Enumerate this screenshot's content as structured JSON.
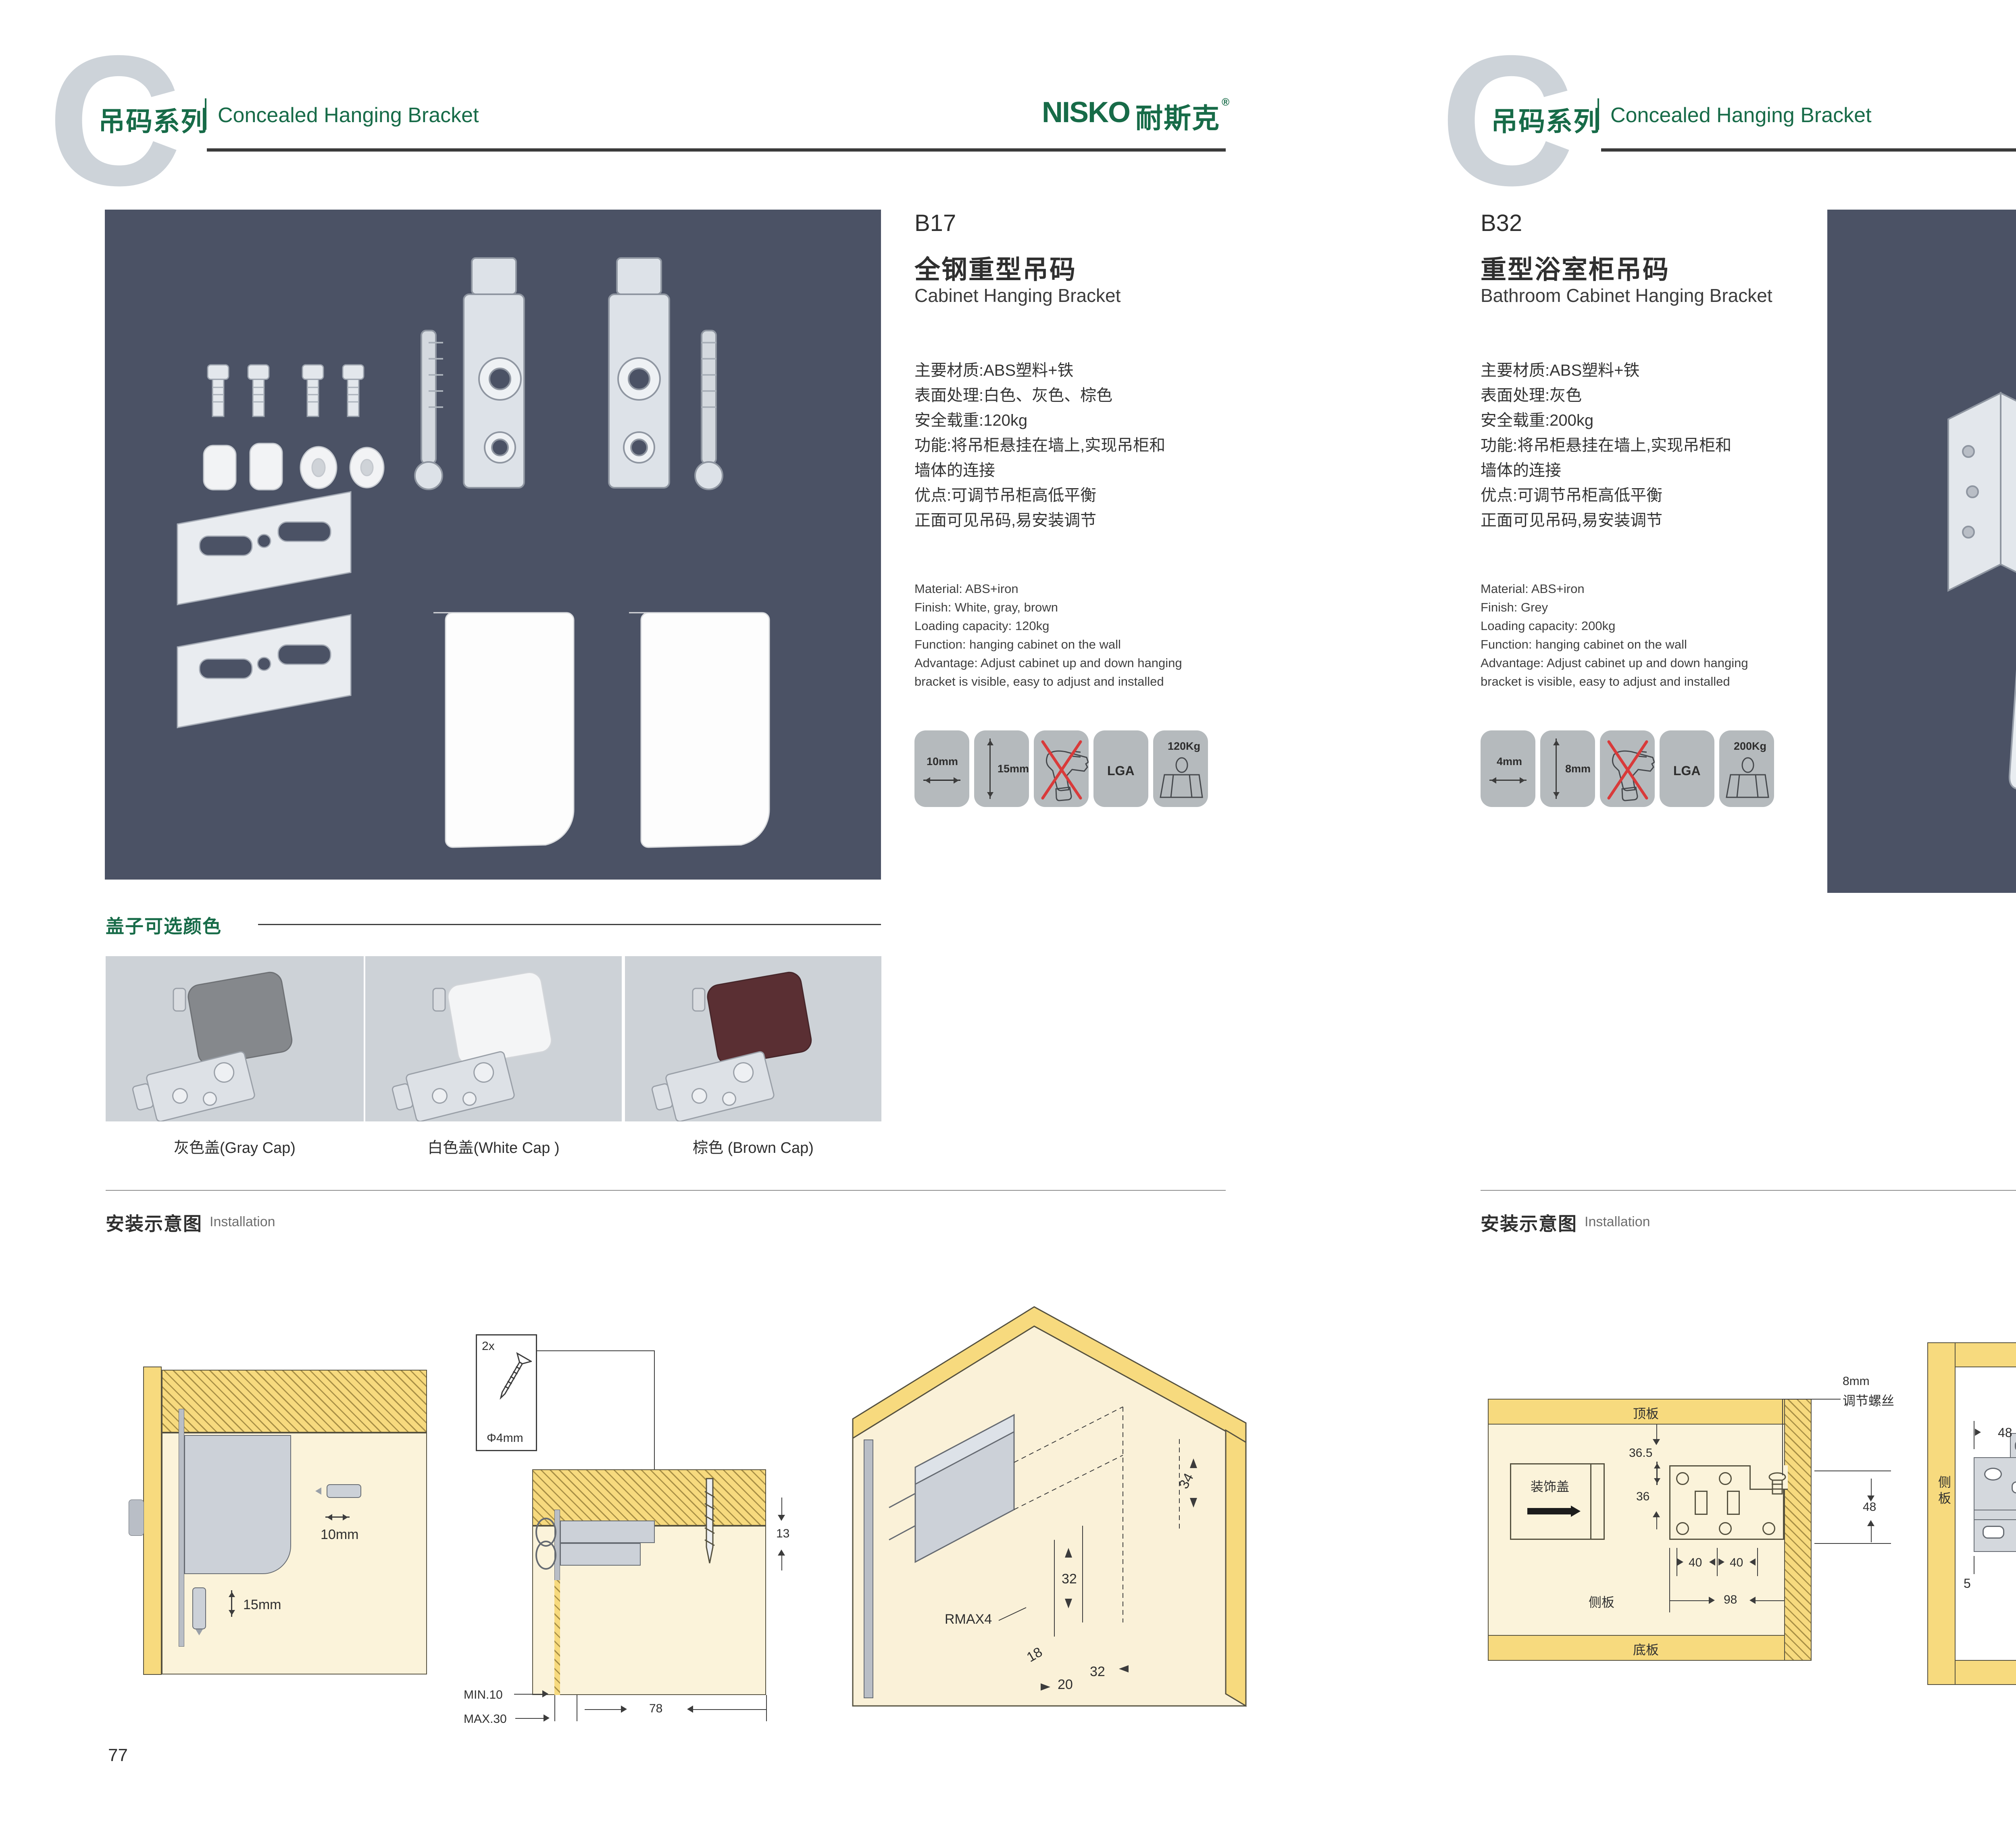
{
  "brand": {
    "logo_text": "NISKO",
    "logo_cn": "耐斯克",
    "registered": "®"
  },
  "header": {
    "series_cn": "吊码系列",
    "series_en": "Concealed Hanging Bracket"
  },
  "install": {
    "heading_cn": "安装示意图",
    "heading_en": "Installation"
  },
  "left_page": {
    "page_number": "77",
    "product": {
      "code": "B17",
      "name_cn": "全钢重型吊码",
      "name_en": "Cabinet Hanging Bracket",
      "specs_cn": [
        "主要材质:ABS塑料+铁",
        "表面处理:白色、灰色、棕色",
        "安全载重:120kg",
        "功能:将吊柜悬挂在墙上,实现吊柜和",
        "墙体的连接",
        "优点:可调节吊柜高低平衡",
        "正面可见吊码,易安装调节"
      ],
      "specs_en": [
        "Material: ABS+iron",
        "Finish: White, gray, brown",
        "Loading capacity: 120kg",
        "Function: hanging cabinet on the wall",
        "Advantage: Adjust cabinet up and down hanging",
        "bracket is visible, easy to adjust and installed"
      ],
      "icon_width": "10mm",
      "icon_height": "15mm",
      "icon_cert": "LGA",
      "icon_load": "120Kg"
    },
    "caps": {
      "heading": "盖子可选颜色",
      "labels": [
        "灰色盖(Gray Cap)",
        "白色盖(White Cap )",
        "棕色 (Brown Cap)"
      ],
      "colors": [
        "#85888c",
        "#f4f5f6",
        "#5a2f33"
      ]
    },
    "diagram1": {
      "dim_w": "10mm",
      "dim_h": "15mm"
    },
    "diagram2": {
      "qty": "2x",
      "dia": "Φ4mm",
      "dim_13": "13",
      "dim_min": "MIN.10",
      "dim_max": "MAX.30",
      "dim_78": "78"
    },
    "diagram3": {
      "dim_34": "34",
      "dim_32a": "32",
      "dim_r": "RMAX4",
      "dim_18": "18",
      "dim_20": "20",
      "dim_32b": "32"
    }
  },
  "right_page": {
    "page_number": "78",
    "product": {
      "code": "B32",
      "name_cn": "重型浴室柜吊码",
      "name_en": "Bathroom Cabinet Hanging Bracket",
      "specs_cn": [
        "主要材质:ABS塑料+铁",
        "表面处理:灰色",
        "安全载重:200kg",
        "功能:将吊柜悬挂在墙上,实现吊柜和",
        "墙体的连接",
        "优点:可调节吊柜高低平衡",
        "正面可见吊码,易安装调节"
      ],
      "specs_en": [
        "Material: ABS+iron",
        "Finish: Grey",
        "Loading capacity: 200kg",
        "Function: hanging cabinet on the wall",
        "Advantage: Adjust cabinet up and down hanging",
        "bracket is visible, easy to adjust and installed"
      ],
      "icon_width": "4mm",
      "icon_height": "8mm",
      "icon_cert": "LGA",
      "icon_load": "200Kg"
    },
    "diagram1": {
      "top": "顶板",
      "deco": "装饰盖",
      "side": "侧板",
      "bottom": "底板",
      "dim_365": "36.5",
      "dim_36": "36",
      "dim_40a": "40",
      "dim_40b": "40",
      "dim_98": "98",
      "note1": "8mm",
      "note2": "调节螺丝",
      "dim_48": "48"
    },
    "diagram2": {
      "top": "顶板",
      "side_l": "侧板",
      "side_r": "侧板",
      "bottom": "底板",
      "dim_48": "48",
      "dim_80": "80",
      "dim_5l": "5",
      "dim_5r": "5"
    },
    "diagram3": {
      "dim_18": "18",
      "dim_35": "35",
      "dim_47": "47",
      "dim_24": "24"
    }
  }
}
